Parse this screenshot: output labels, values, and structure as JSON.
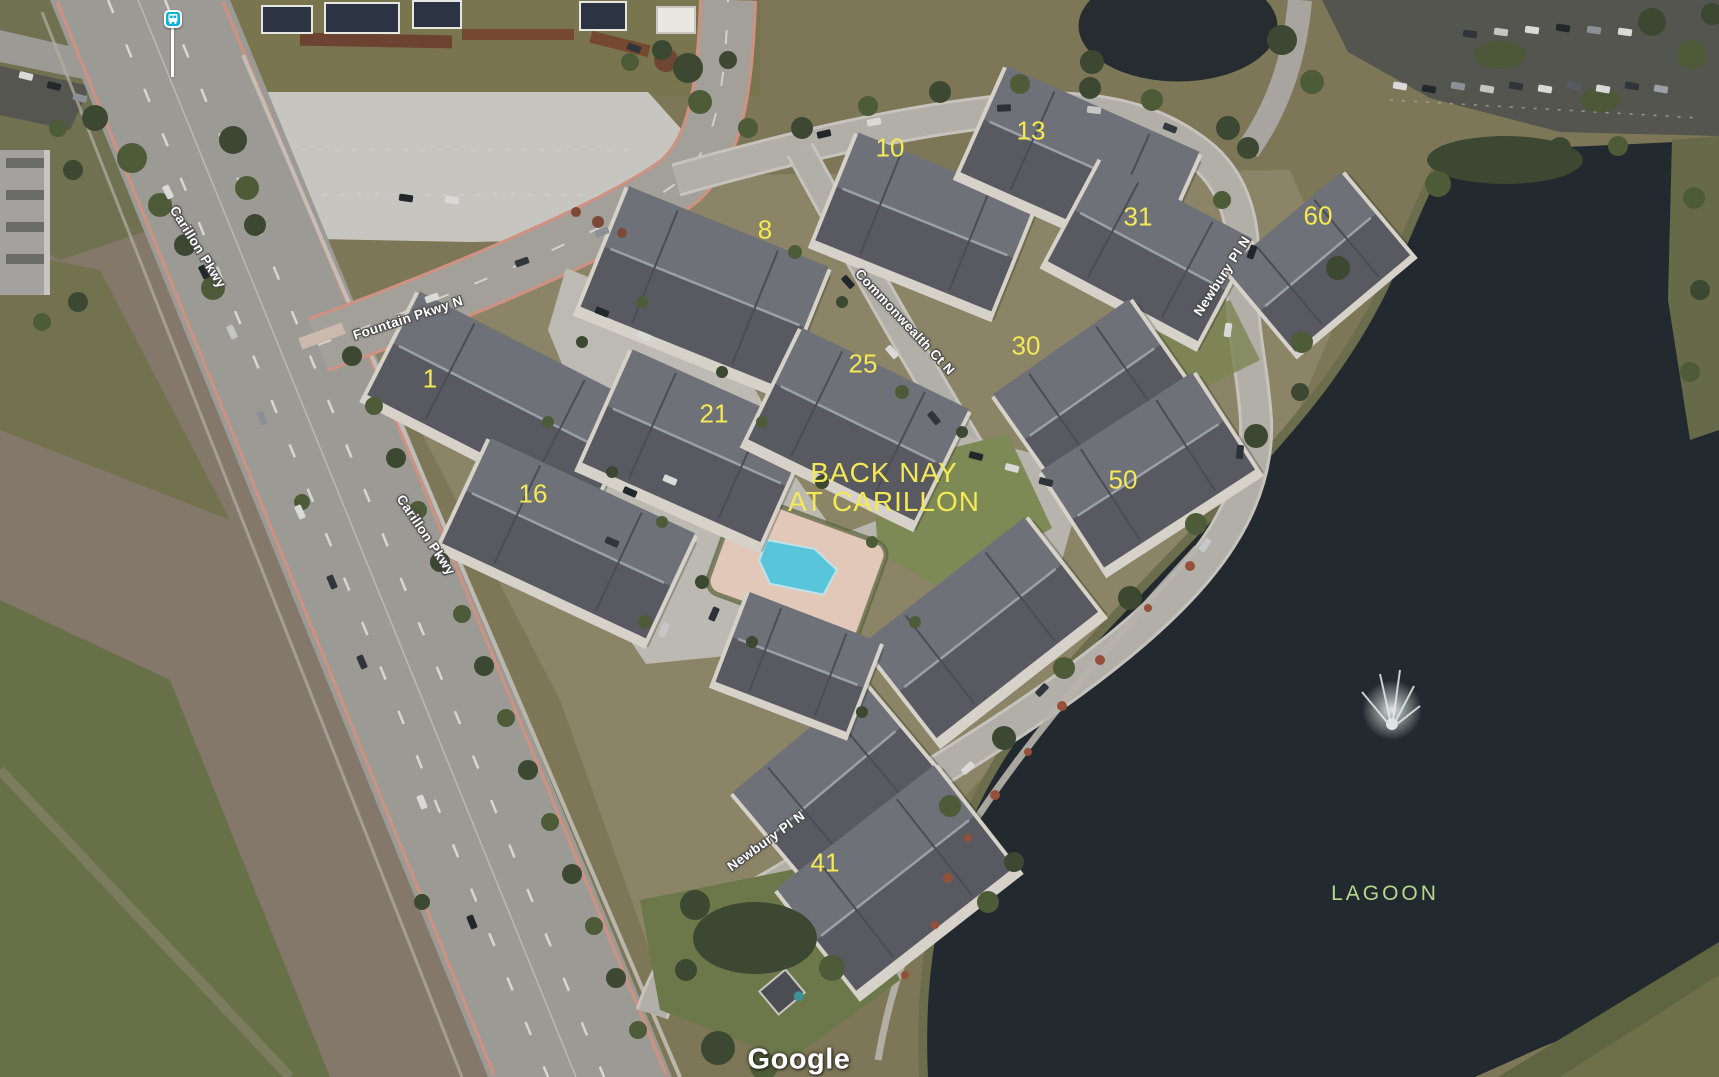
{
  "map": {
    "attribution": "Google",
    "community_label": {
      "line1": "BACK NAY",
      "line2": "AT CARILLON"
    },
    "water_label": "LAGOON",
    "street_labels": [
      "Carillon Pkwy",
      "Carillon Pkwy",
      "Fountain Pkwy N",
      "Commonwealth Ct N",
      "Newbury Pl N",
      "Newbury Pl N"
    ],
    "building_numbers": [
      "1",
      "8",
      "10",
      "13",
      "16",
      "21",
      "25",
      "30",
      "31",
      "41",
      "50",
      "60"
    ],
    "icons": {
      "bus_stop": "bus-stop-icon"
    },
    "colors": {
      "building_number_yellow": "#f3e855",
      "water_label_green": "#b5d88e",
      "street_label_fill": "#ffffff",
      "street_label_outline": "#4b4b4b",
      "lagoon_water": "#232a2f",
      "transit_icon_blue": "#0ab2d8",
      "pool_water": "#58c5db"
    }
  }
}
